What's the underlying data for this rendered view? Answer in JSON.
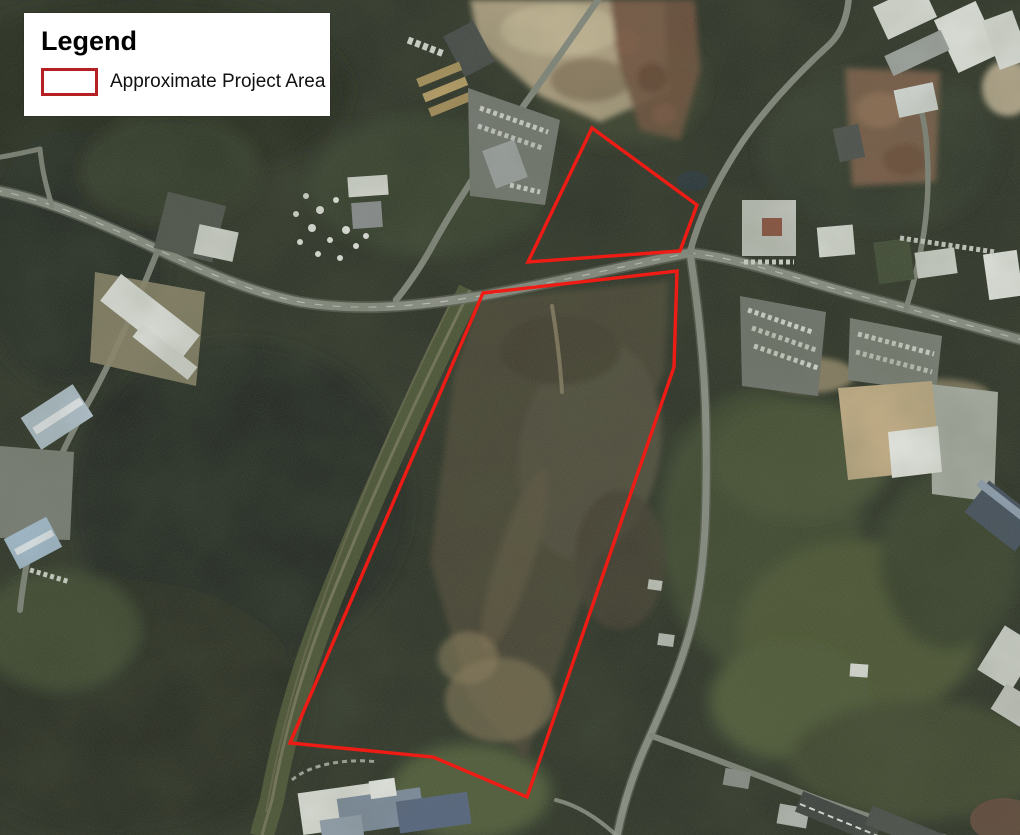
{
  "legend": {
    "title": "Legend",
    "items": [
      {
        "label": "Approximate Project Area",
        "swatch_fill": "#ffffff",
        "swatch_border": "#b52025"
      }
    ]
  },
  "project_area": {
    "color": "#ee1c14",
    "stroke_width": 3.4,
    "polygons": [
      {
        "name": "north-parcel",
        "points": [
          [
            592,
            128
          ],
          [
            697,
            205
          ],
          [
            680,
            251
          ],
          [
            528,
            262
          ]
        ]
      },
      {
        "name": "south-parcel",
        "points": [
          [
            483,
            293
          ],
          [
            677,
            271
          ],
          [
            674,
            367
          ],
          [
            527,
            797
          ],
          [
            433,
            757
          ],
          [
            290,
            743
          ]
        ]
      }
    ]
  },
  "map": {
    "type": "satellite-aerial-imagery",
    "palette": {
      "forest_dark": "#252b20",
      "field_olive": "#47512f",
      "road_gray": "#898d84",
      "cleared_ground": "#453f31",
      "sand_dirt": "#b3a183",
      "scrap_brown": "#6e4a38"
    }
  }
}
